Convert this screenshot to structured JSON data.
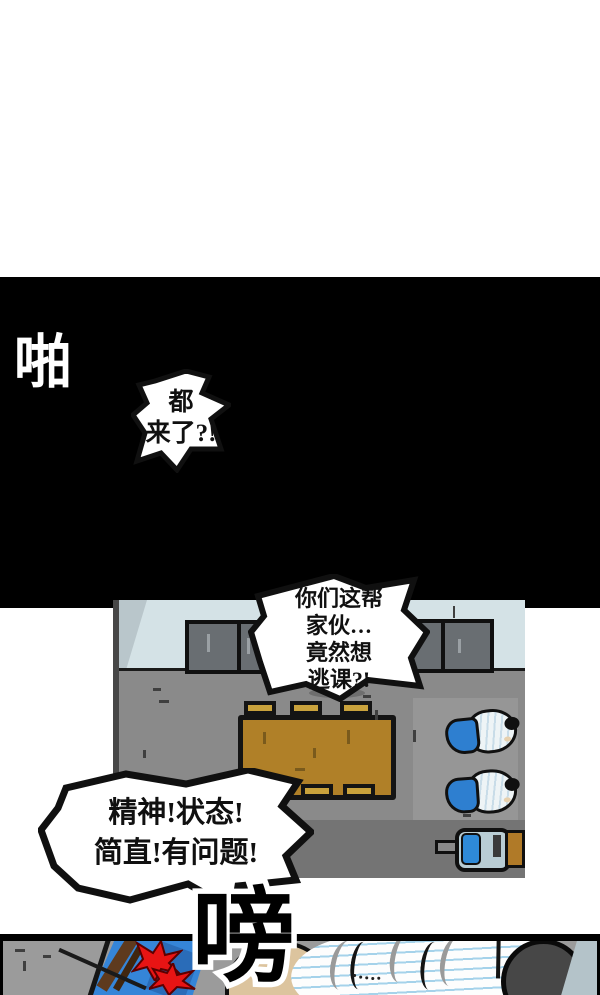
{
  "comic": {
    "panel1_sfx": "啪",
    "panel2_sfx": "嗙",
    "bubble1": {
      "lines": [
        "都",
        "来了?!"
      ]
    },
    "bubble2": {
      "lines": [
        "你们这帮",
        "家伙…",
        "竟然想",
        "逃课?!"
      ]
    },
    "bubble3": {
      "lines": [
        "精神!状态!",
        "简直!有问题!"
      ]
    }
  },
  "palette": {
    "page_bg": "#ffffff",
    "panel_bg": "#000000",
    "wall": "#d4e2e6",
    "floor": "#8a8a8a",
    "table_brown": "#b08028",
    "door_brown": "#a87f2e",
    "jacket_blue": "#2e7fd0",
    "shirt_blue": "#b5d9e9",
    "impact_red": "#e81414",
    "notebook_line": "#a5d2ea",
    "skin_tan": "#dcc49e"
  }
}
